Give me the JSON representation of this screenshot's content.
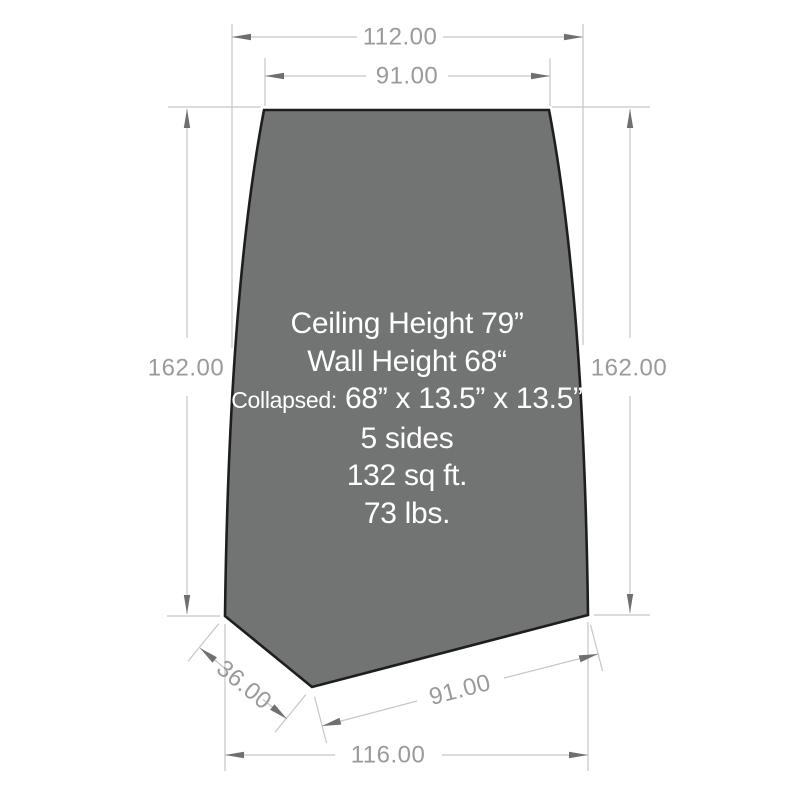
{
  "dimensions": {
    "top_width": "112.00",
    "top_edge": "91.00",
    "left_height": "162.00",
    "right_height": "162.00",
    "bottom_left_edge": "36.00",
    "bottom_right_edge": "91.00",
    "bottom_width": "116.00"
  },
  "specs": {
    "ceiling_height": "Ceiling Height 79”",
    "wall_height": "Wall Height 68“",
    "collapsed_label": "Collapsed:",
    "collapsed_value": "68” x 13.5” x 13.5”",
    "sides": "5 sides",
    "area": "132 sq ft.",
    "weight": "73 lbs."
  },
  "colors": {
    "background": "#ffffff",
    "panel_fill": "#727474",
    "panel_outline": "#1e1e1e",
    "dim_line": "#c6c6c6",
    "dim_text": "#9a9a9a",
    "arrow": "#6f6f6f",
    "spec_text": "#ffffff"
  }
}
